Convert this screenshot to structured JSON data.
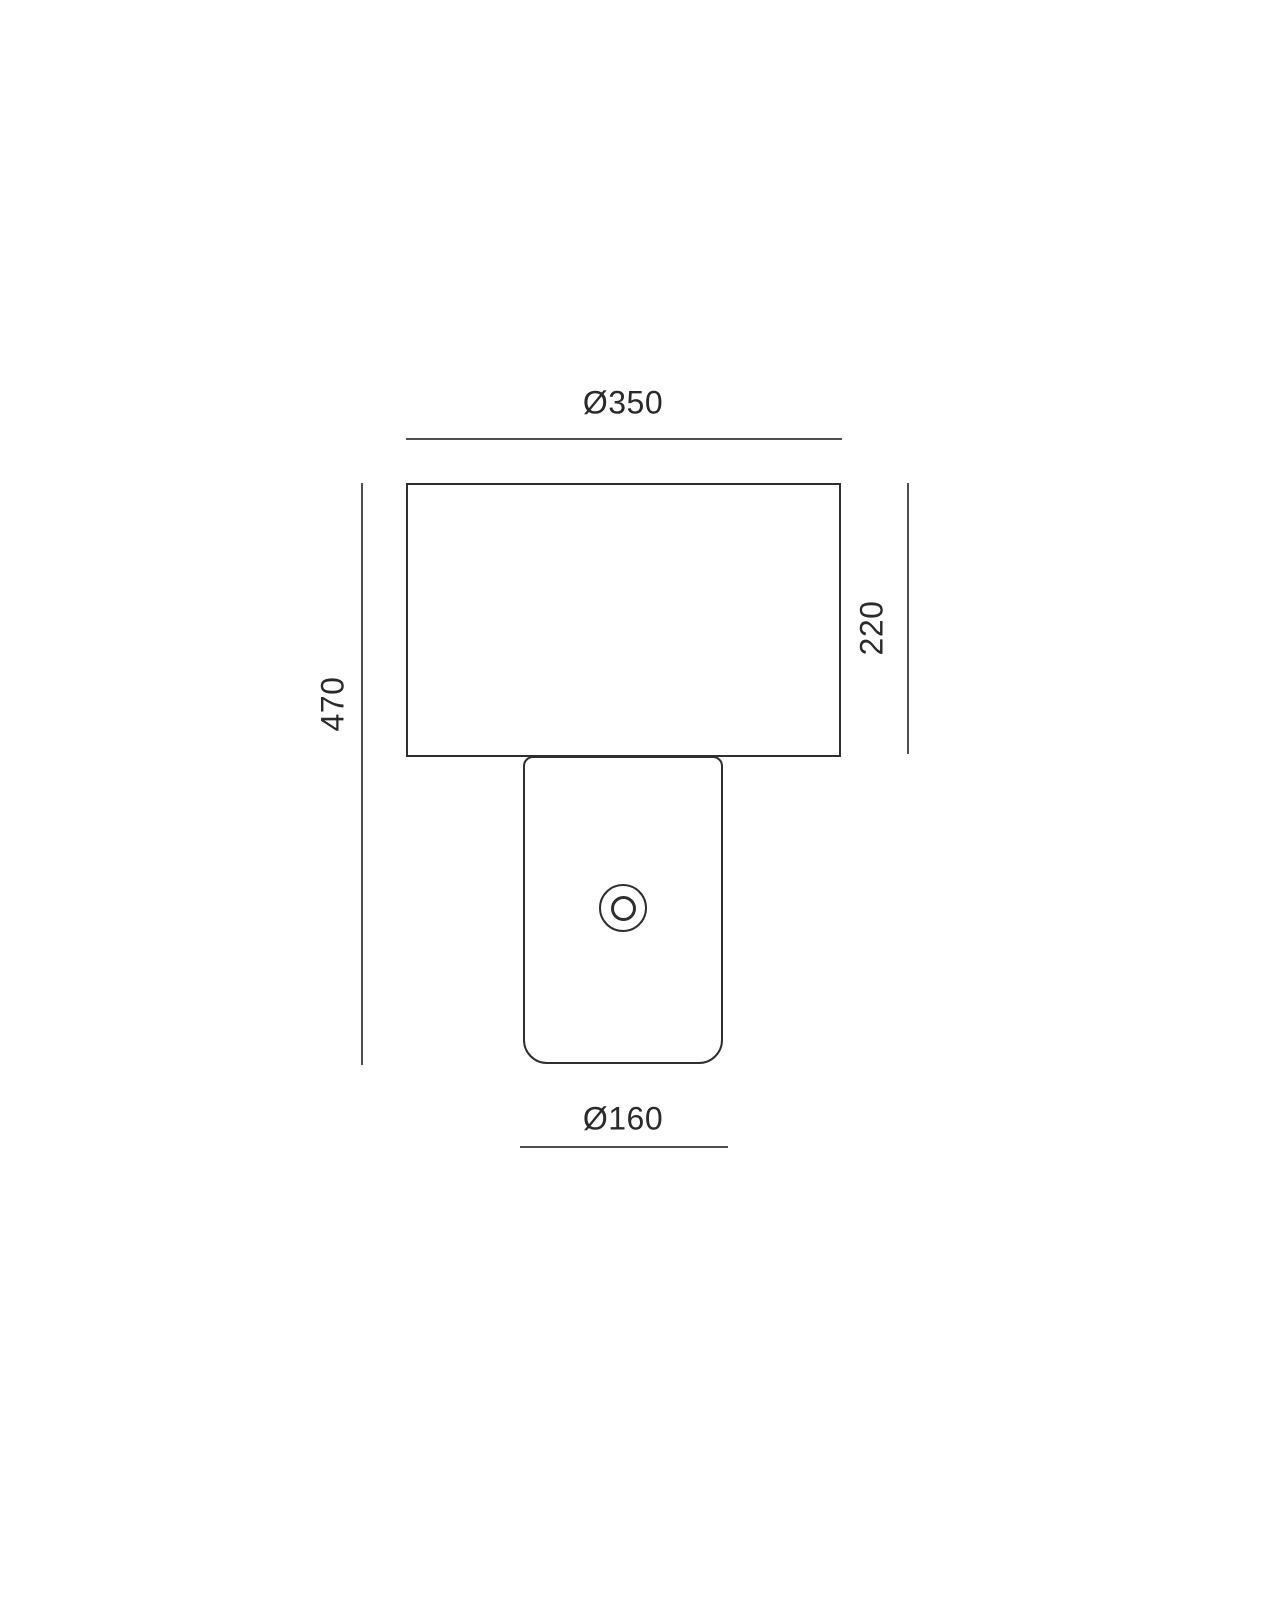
{
  "drawing": {
    "name": "table-lamp-dimension-drawing",
    "colors": {
      "outline": "#2e2e31",
      "dimension_line": "#4e4e52",
      "text": "#2a2a2d",
      "background": "#ffffff"
    },
    "dimensions": {
      "shade_diameter": {
        "label": "Ø350",
        "value": 350
      },
      "shade_height": {
        "label": "220",
        "value": 220
      },
      "total_height": {
        "label": "470",
        "value": 470
      },
      "base_diameter": {
        "label": "Ø160",
        "value": 160
      }
    }
  }
}
